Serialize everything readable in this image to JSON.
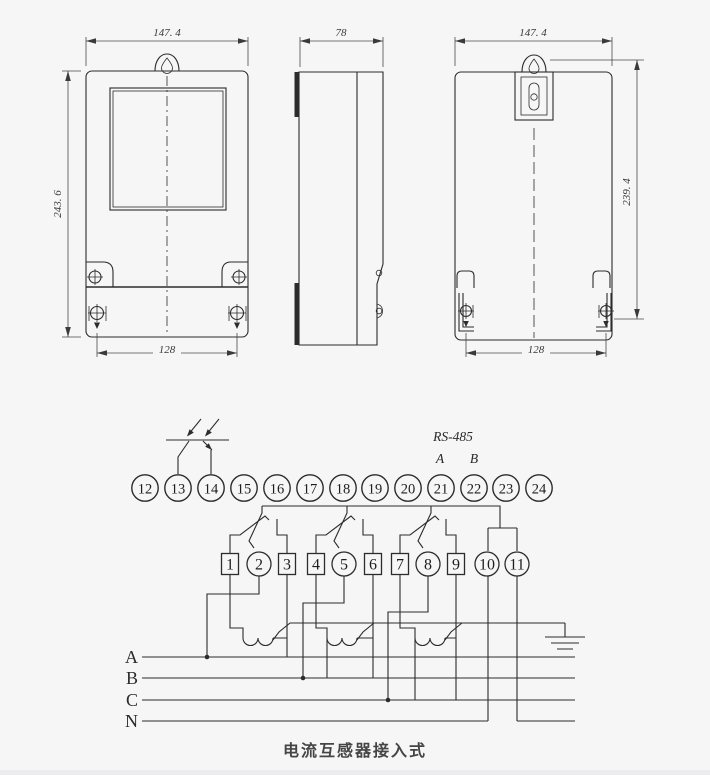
{
  "views": {
    "front": {
      "dim_width": "147. 4",
      "dim_height": "243. 6",
      "dim_mount": "128"
    },
    "side": {
      "dim_width": "78"
    },
    "back": {
      "dim_width": "147. 4",
      "dim_height": "239. 4",
      "dim_mount": "128"
    }
  },
  "wiring": {
    "top_terminals": [
      "12",
      "13",
      "14",
      "15",
      "16",
      "17",
      "18",
      "19",
      "20",
      "21",
      "22",
      "23",
      "24"
    ],
    "bottom_terminals": [
      {
        "label": "1",
        "shape": "square"
      },
      {
        "label": "2",
        "shape": "circle"
      },
      {
        "label": "3",
        "shape": "square"
      },
      {
        "label": "4",
        "shape": "square"
      },
      {
        "label": "5",
        "shape": "circle"
      },
      {
        "label": "6",
        "shape": "square"
      },
      {
        "label": "7",
        "shape": "square"
      },
      {
        "label": "8",
        "shape": "circle"
      },
      {
        "label": "9",
        "shape": "square"
      },
      {
        "label": "10",
        "shape": "circle"
      },
      {
        "label": "11",
        "shape": "circle"
      }
    ],
    "rs485": {
      "label": "RS-485",
      "line_a": "A",
      "line_b": "B"
    },
    "phases": [
      "A",
      "B",
      "C",
      "N"
    ],
    "caption": "电流互感器接入式"
  },
  "colors": {
    "background": "#f6f6f7",
    "line": "#2c2c2c",
    "text": "#3a3a3a"
  }
}
